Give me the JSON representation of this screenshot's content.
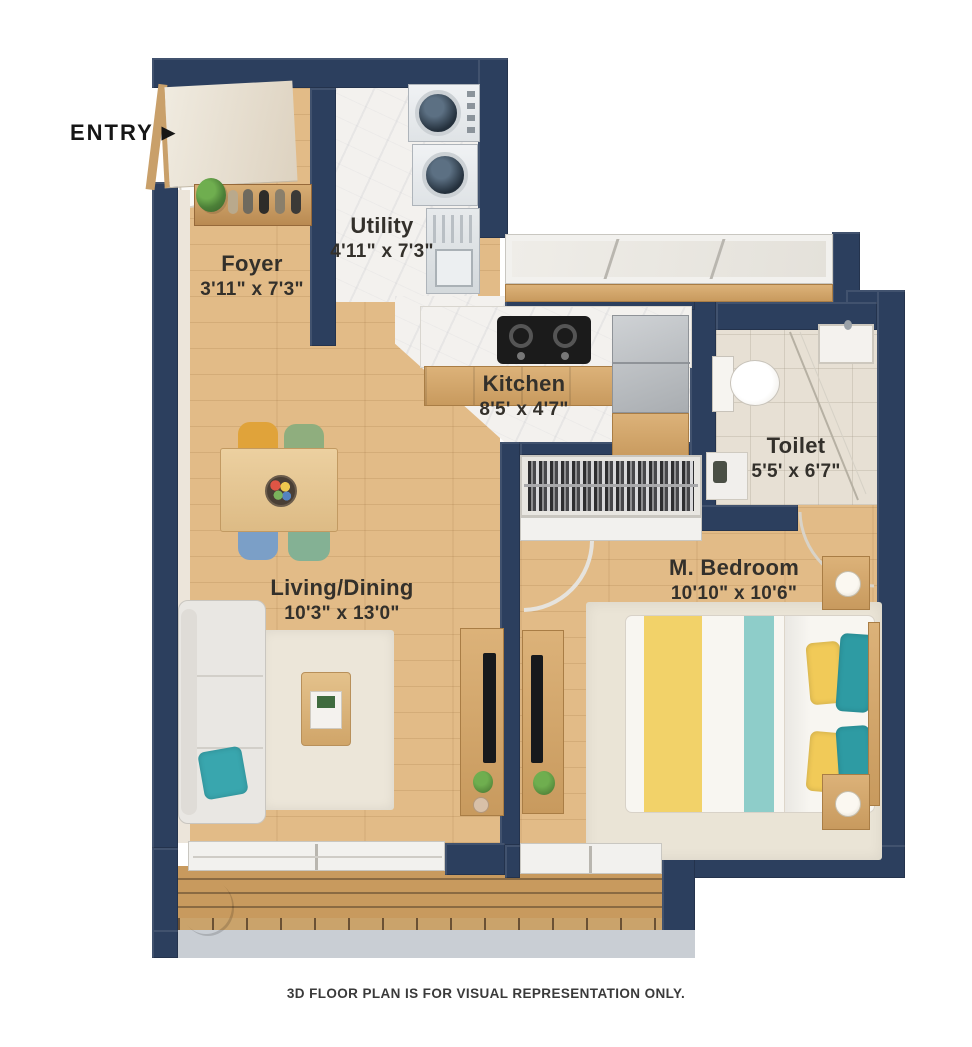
{
  "entry": {
    "label": "ENTRY",
    "arrow": "▶"
  },
  "rooms": [
    {
      "id": "foyer",
      "name": "Foyer",
      "dims": "3'11\" x 7'3\""
    },
    {
      "id": "utility",
      "name": "Utility",
      "dims": "4'11\" x 7'3\""
    },
    {
      "id": "kitchen",
      "name": "Kitchen",
      "dims": "8'5' x 4'7\""
    },
    {
      "id": "toilet",
      "name": "Toilet",
      "dims": "5'5' x 6'7\""
    },
    {
      "id": "bedroom",
      "name": "M. Bedroom",
      "dims": "10'10\" x 10'6\""
    },
    {
      "id": "living",
      "name": "Living/Dining",
      "dims": "10'3\" x 13'0\""
    }
  ],
  "footer": {
    "disclaimer": "3D FLOOR PLAN IS FOR VISUAL REPRESENTATION ONLY."
  },
  "colors": {
    "wall_navy": "#2c3f5e",
    "wood_floor": "#e2bb87",
    "marble_floor": "#f3f1ee",
    "toilet_tile": "#e7e0d4",
    "balcony_deck": "#c89a5e",
    "accent_teal": "#2e9ba3",
    "accent_yellow": "#f2d269",
    "label_text": "#33302b"
  },
  "furniture": [
    "entry-door",
    "shoe-rack",
    "washer",
    "dryer",
    "utility-sink",
    "hob",
    "fridge",
    "toilet",
    "wash-basin",
    "wardrobe",
    "bed",
    "nightstand",
    "table-lamp",
    "tv-unit",
    "sofa",
    "dining-table",
    "coffee-table",
    "rug",
    "balcony-plant",
    "sliding-door",
    "window"
  ]
}
